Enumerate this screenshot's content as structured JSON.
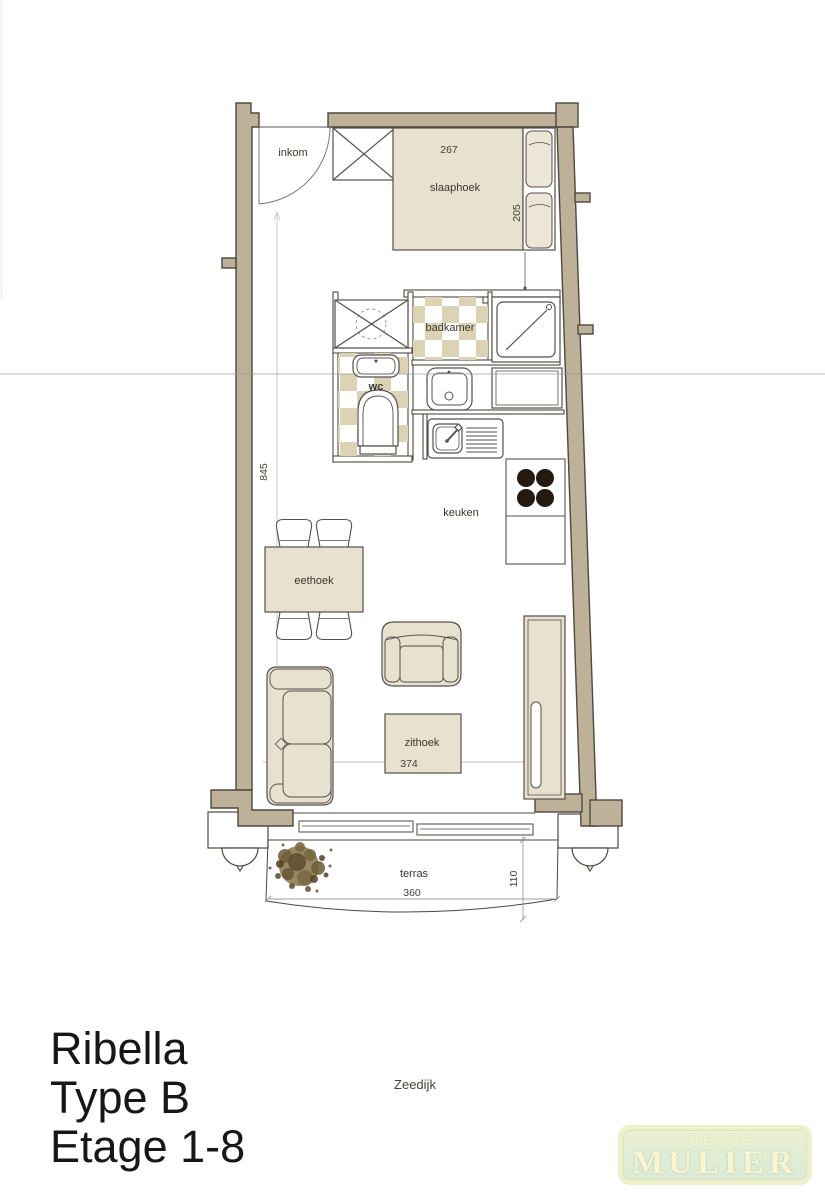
{
  "plan": {
    "rooms": {
      "inkom": "inkom",
      "slaaphoek": "slaaphoek",
      "badkamer": "badkamer",
      "wc": "wc",
      "keuken": "keuken",
      "eethoek": "eethoek",
      "zithoek": "zithoek",
      "terras": "terras"
    },
    "dims": {
      "bed_width": "267",
      "bed_depth": "205",
      "apartment_length": "845",
      "zithoek_width": "374",
      "terras_width": "360",
      "terras_depth": "110"
    },
    "street": "Zeedijk"
  },
  "footer": {
    "line1": "Ribella",
    "line2": "Type B",
    "line3": "Etage 1-8"
  },
  "logo": {
    "agence": "AGENCE",
    "mulier": "MULIER"
  },
  "colors": {
    "wall": "#bdb299",
    "outline": "#4e483e",
    "furniture": "#e8e1cf",
    "pillow": "#ece6d6",
    "tile": "#dcd2b4",
    "burner": "#241a10",
    "plant": "#7b6944",
    "dim_line": "#96a0a8",
    "logo_border": "#eef0c9",
    "logo_bg": "#e2edd6",
    "logo_text": "#f9f5d3"
  }
}
